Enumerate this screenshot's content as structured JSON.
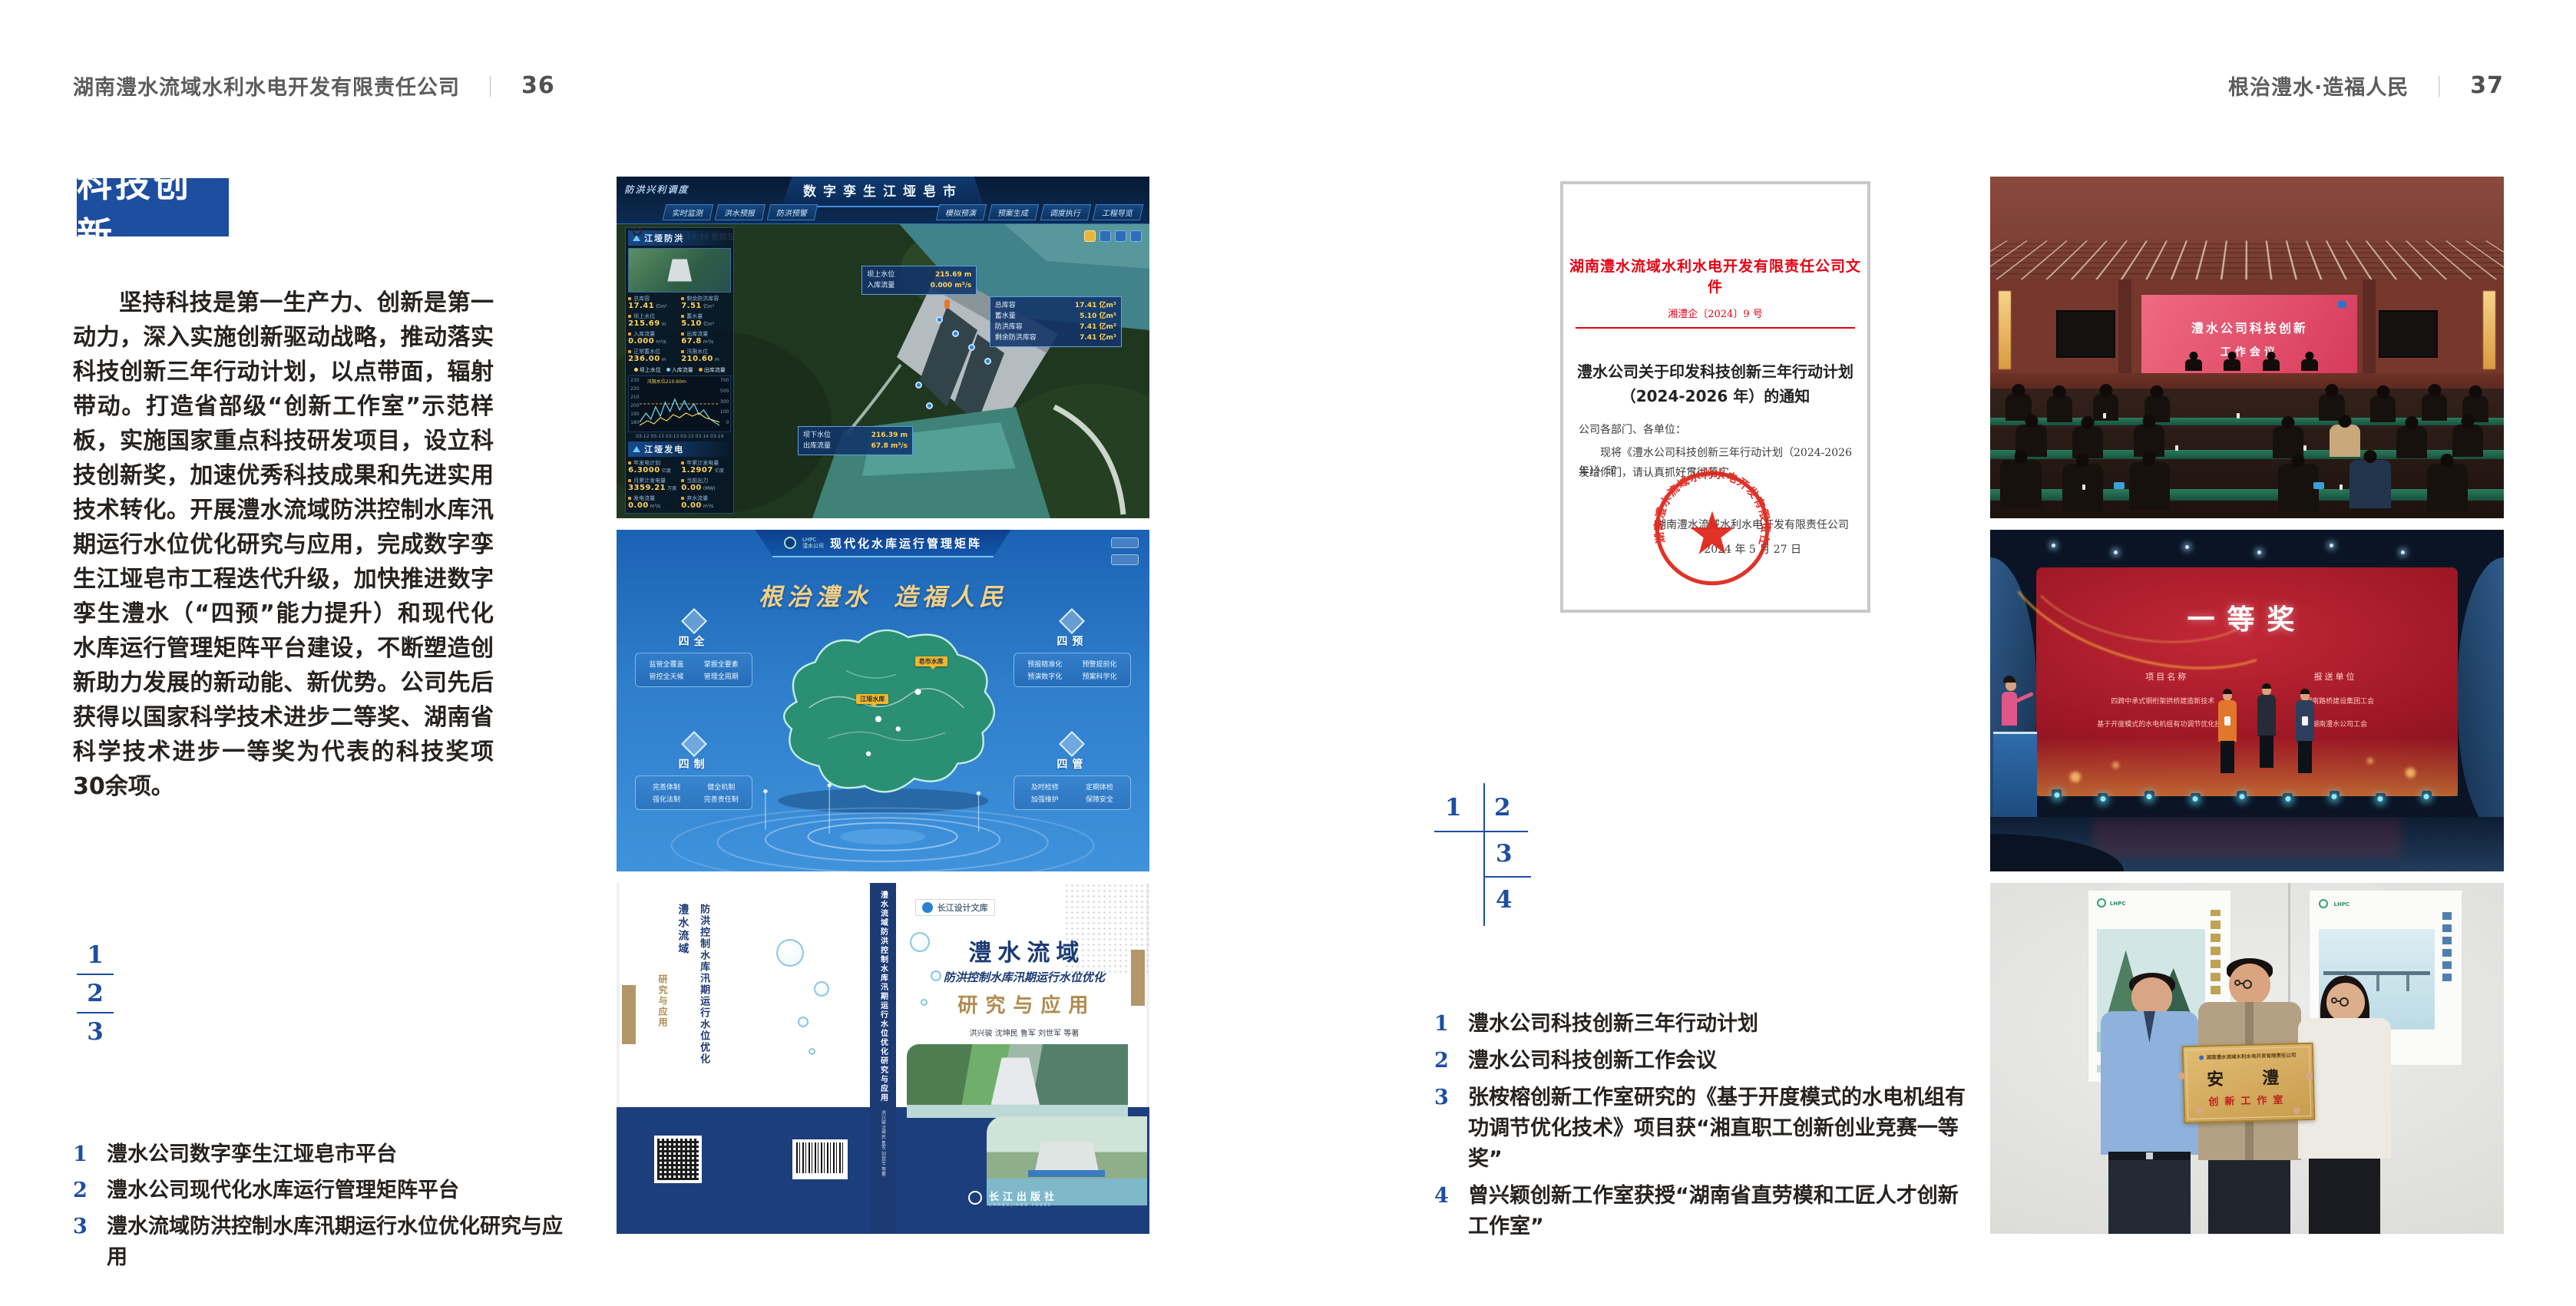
{
  "left_page": {
    "header": {
      "company": "湖南澧水流域水利水电开发有限责任公司",
      "divider": "｜",
      "page_num": "36"
    },
    "section_title": "科技创新",
    "paragraph": "坚持科技是第一生产力、创新是第一动力，深入实施创新驱动战略，推动落实科技创新三年行动计划，以点带面，辐射带动。打造省部级“创新工作室”示范样板，实施国家重点科技研发项目，设立科技创新奖，加速优秀科技成果和先进实用技术转化。开展澧水流域防洪控制水库汛期运行水位优化研究与应用，完成数字孪生江垭皂市工程迭代升级，加快推进数字孪生澧水（“四预”能力提升）和现代化水库运行管理矩阵平台建设，不断塑造创新助力发展的新动能、新优势。公司先后获得以国家科学技术进步二等奖、湖南省科学技术进步一等奖为代表的科技奖项30余项。",
    "figure_index": [
      "1",
      "2",
      "3"
    ],
    "captions": [
      {
        "num": "1",
        "text": "澧水公司数字孪生江垭皂市平台"
      },
      {
        "num": "2",
        "text": "澧水公司现代化水库运行管理矩阵平台"
      },
      {
        "num": "3",
        "text": "澧水流域防洪控制水库汛期运行水位优化研究与应用"
      }
    ]
  },
  "right_page": {
    "header": {
      "slogan": "根治澧水·造福人民",
      "divider": "｜",
      "page_num": "37"
    },
    "document": {
      "masthead": "湖南澧水流域水利水电开发有限责任公司文件",
      "doc_no": "湘澧企〔2024〕9 号",
      "title_line1": "澧水公司关于印发科技创新三年行动计划",
      "title_line2": "（2024-2026 年）的通知",
      "salutation": "公司各部门、各单位：",
      "body_line1": "现将《澧水公司科技创新三年行动计划（2024-2026 年）》印",
      "body_line2": "发给你们，请认真抓好贯彻落实。",
      "signer": "湖南澧水流域水利水电开发有限责任公司",
      "date": "2024 年 5 月 27 日",
      "seal": "湖南澧水流域水利水电开发有限责任公司"
    },
    "figure_index": [
      "1",
      "2",
      "3",
      "4"
    ],
    "captions": [
      {
        "num": "1",
        "text": "澧水公司科技创新三年行动计划"
      },
      {
        "num": "2",
        "text": "澧水公司科技创新工作会议"
      },
      {
        "num": "3",
        "text": "张桉榕创新工作室研究的《基于开度模式的水电机组有功调节优化技术》项目获“湘直职工创新创业竞赛一等奖”"
      },
      {
        "num": "4",
        "text": "曾兴颖创新工作室获授“湖南省直劳模和工匠人才创新工作室”"
      }
    ]
  },
  "f1": {
    "corner": "防洪兴利调度",
    "title": "数字孪生江垭皂市",
    "tabsL": [
      "实时监测",
      "洪水预报",
      "防洪预警"
    ],
    "tabsR": [
      "模拟预演",
      "预案生成",
      "调度执行",
      "工程导览"
    ],
    "dt": "2024-03-15 13:14:38 星期五",
    "panel1": "江垭防洪",
    "stats": [
      {
        "l": "总库容",
        "v": "17.41",
        "u": "亿m³"
      },
      {
        "l": "剩余防洪库容",
        "v": "7.51",
        "u": "亿m³"
      },
      {
        "l": "坝上水位",
        "v": "215.69",
        "u": "m"
      },
      {
        "l": "蓄水量",
        "v": "5.10",
        "u": "亿m³"
      },
      {
        "l": "入库流量",
        "v": "0.000",
        "u": "m³/s"
      },
      {
        "l": "出库流量",
        "v": "67.8",
        "u": "m³/s"
      },
      {
        "l": "正常蓄水位",
        "v": "236.00",
        "u": "m"
      },
      {
        "l": "汛限水位",
        "v": "210.60",
        "u": "m"
      }
    ],
    "chart": {
      "legend": [
        "坝上水位",
        "入库流量",
        "出库流量"
      ],
      "note": "汛限水位210.60m",
      "axl": "水位(m)",
      "axr": "流量m³/s",
      "yl": [
        "230",
        "220",
        "210",
        "200",
        "190",
        "180"
      ],
      "yr": [
        "700",
        "500",
        "300",
        "100",
        "0"
      ],
      "x": [
        "03-12",
        "03-13",
        "03-13",
        "03-13",
        "03-14",
        "03-14"
      ]
    },
    "panel2": "江垭发电",
    "gen": [
      {
        "l": "年发电计划",
        "v": "6.3000",
        "u": "亿度"
      },
      {
        "l": "年累计发电量",
        "v": "1.2907",
        "u": "亿度"
      },
      {
        "l": "月累计发电量",
        "v": "3359.21",
        "u": "万度"
      },
      {
        "l": "当前出力",
        "v": "0.00",
        "u": "(MW)"
      },
      {
        "l": "发电流量",
        "v": "0.00",
        "u": "m³/s"
      },
      {
        "l": "弃水流量",
        "v": "0.00",
        "u": "m³/s"
      }
    ],
    "gauges": [
      {
        "v": "0.00",
        "l": "1#机组"
      },
      {
        "v": "102.98",
        "l": "2#机组"
      },
      {
        "v": "0.00",
        "l": "3#机组"
      }
    ],
    "tipUp": [
      [
        "坝上水位",
        "215.69 m"
      ],
      [
        "入库流量",
        "0.000 m³/s"
      ]
    ],
    "tipRight": [
      [
        "总库容",
        "17.41 亿m³"
      ],
      [
        "蓄水量",
        "5.10 亿m³"
      ],
      [
        "防洪库容",
        "7.41 亿m³"
      ],
      [
        "剩余防洪库容",
        "7.41 亿m³"
      ]
    ],
    "tipDown": [
      [
        "坝下水位",
        "216.39 m"
      ],
      [
        "出库流量",
        "67.8 m³/s"
      ]
    ]
  },
  "f2": {
    "logo": "LHPC",
    "logo_sub": "澧水公司",
    "title": "现代化水库运行管理矩阵",
    "slogan1": "根治澧水",
    "slogan2": "造福人民",
    "groups": [
      {
        "name": "四全",
        "items": [
          "监管全覆盖",
          "掌握全要素",
          "管控全天候",
          "管理全周期"
        ]
      },
      {
        "name": "四制",
        "items": [
          "完善体制",
          "健全机制",
          "强化法制",
          "完善责任制"
        ]
      },
      {
        "name": "四预",
        "items": [
          "预报精准化",
          "预警提前化",
          "预演数字化",
          "预案科学化"
        ]
      },
      {
        "name": "四管",
        "items": [
          "及时检修",
          "定期体检",
          "加强维护",
          "保障安全"
        ]
      }
    ],
    "label1": "皂市水库",
    "label2": "江垭水库"
  },
  "f3": {
    "series": "长江设计文库",
    "t1": "澧水流域",
    "t2": "防洪控制水库汛期运行水位优化",
    "t3": "研究与应用",
    "authors": "洪兴骏  沈坤民  鲁军  刘世军  等著",
    "publisher": "长江出版社",
    "publisher_en": "CHANGJIANG PRESS",
    "spine": "澧水流域防洪控制水库汛期运行水位优化研究与应用"
  },
  "p1": {
    "screen1": "澧水公司科技创新",
    "screen2": "工作会议"
  },
  "p2": {
    "title": "一等奖",
    "col1": "项目名称",
    "col2": "报送单位",
    "rows": [
      [
        "四跨中承式钢桁架拱桥建造新技术",
        "湖南路桥建设集团工会"
      ],
      [
        "基于开度模式的水电机组有功调节优化技术",
        "湖南澧水公司工会"
      ]
    ]
  },
  "p3": {
    "org": "湖南澧水流域水利水电开发有限责任公司",
    "main": "安　澧",
    "sub": "创新工作室",
    "logo": "LHPC"
  }
}
